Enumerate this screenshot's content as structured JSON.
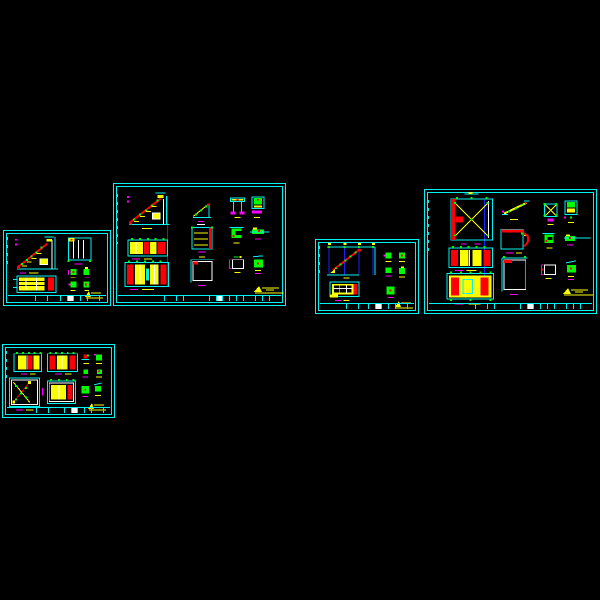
{
  "document": {
    "type": "cad-drawing-preview",
    "background": "#000000",
    "sheet_count": 5,
    "visible_text": ""
  },
  "palette": {
    "bg": "#000000",
    "cyan": "#00f2f2",
    "red": "#fb0006",
    "yellow": "#fbfe00",
    "green": "#00fb00",
    "magenta": "#fb00fb",
    "white": "#ffffff",
    "blue": "#1c24f8"
  },
  "sheets": [
    {
      "id": "sheet-left-small",
      "description": "Small sheet: stair section detail, beam plan detail, frame detail, four node details, title block, yellow approval stamp"
    },
    {
      "id": "sheet-center-large",
      "description": "Large sheet: stair elevation, two wall sections, bracket, ladder section, square frame, six connection details, title block, yellow stamp"
    },
    {
      "id": "sheet-middle-small",
      "description": "Small sheet: stair plan on blue grid, slab panel detail, five node details, title block, yellow stamp"
    },
    {
      "id": "sheet-right-large",
      "description": "Large sheet: braced frame elevation, two sections, diagonal brace, two portal details, six connection details, title block, yellow stamp"
    },
    {
      "id": "sheet-bottom-small",
      "description": "Small sheet: two band sections, braced panel, panel section, six node details, title block, yellow stamp"
    }
  ],
  "stamp": {
    "color": "#fbfe00",
    "shape": "signature-mark"
  }
}
